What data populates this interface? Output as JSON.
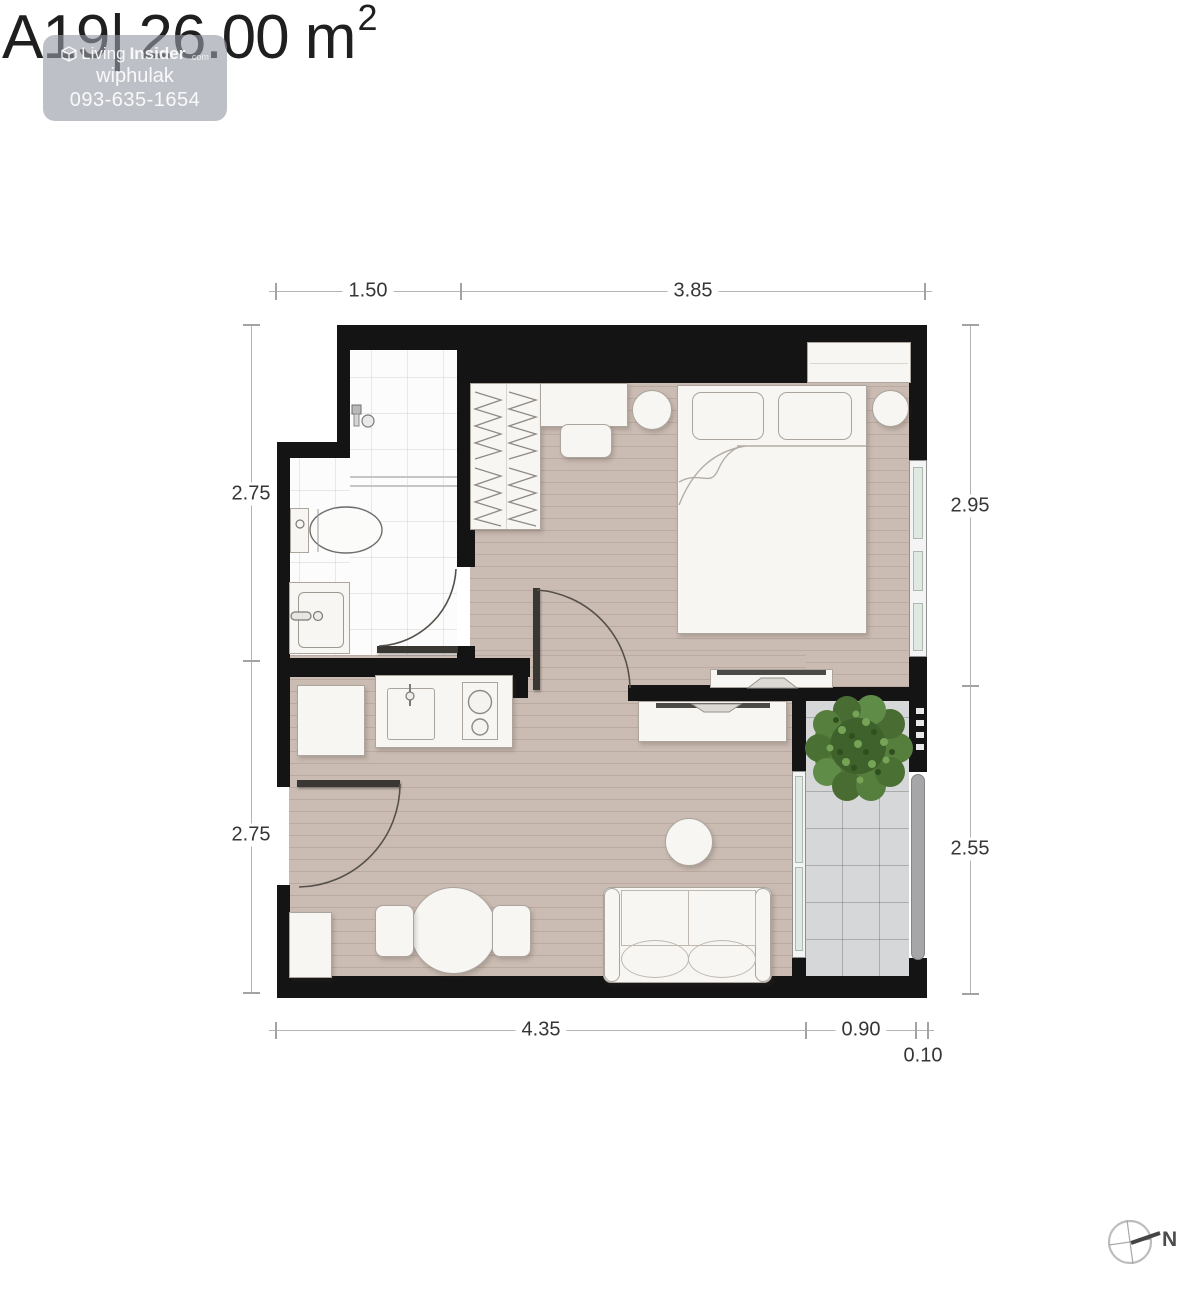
{
  "title": {
    "unit_label": "A19|",
    "area_label": "26.00 m",
    "area_exponent": "2"
  },
  "watermark": {
    "brand_first": "Living",
    "brand_second": "Insider",
    "brand_suffix": ".com",
    "agent_name": "wiphulak",
    "agent_phone": "093-635-1654"
  },
  "dimensions": {
    "top": [
      "1.50",
      "3.85"
    ],
    "left": [
      "2.75",
      "2.75"
    ],
    "right": [
      "2.95",
      "2.55"
    ],
    "bottom": [
      "4.35",
      "0.90",
      "0.10"
    ]
  },
  "compass": {
    "north_label": "N"
  },
  "colors": {
    "wall": "#141414",
    "wood_floor": "#cabcb3",
    "balcony_tile": "#d6d7d9",
    "bathroom_tile": "#fcfcfc",
    "window_glass": "#dfe9e2",
    "plant_green": "#527a38",
    "watermark_bg": "rgba(150,153,166,0.62)"
  }
}
